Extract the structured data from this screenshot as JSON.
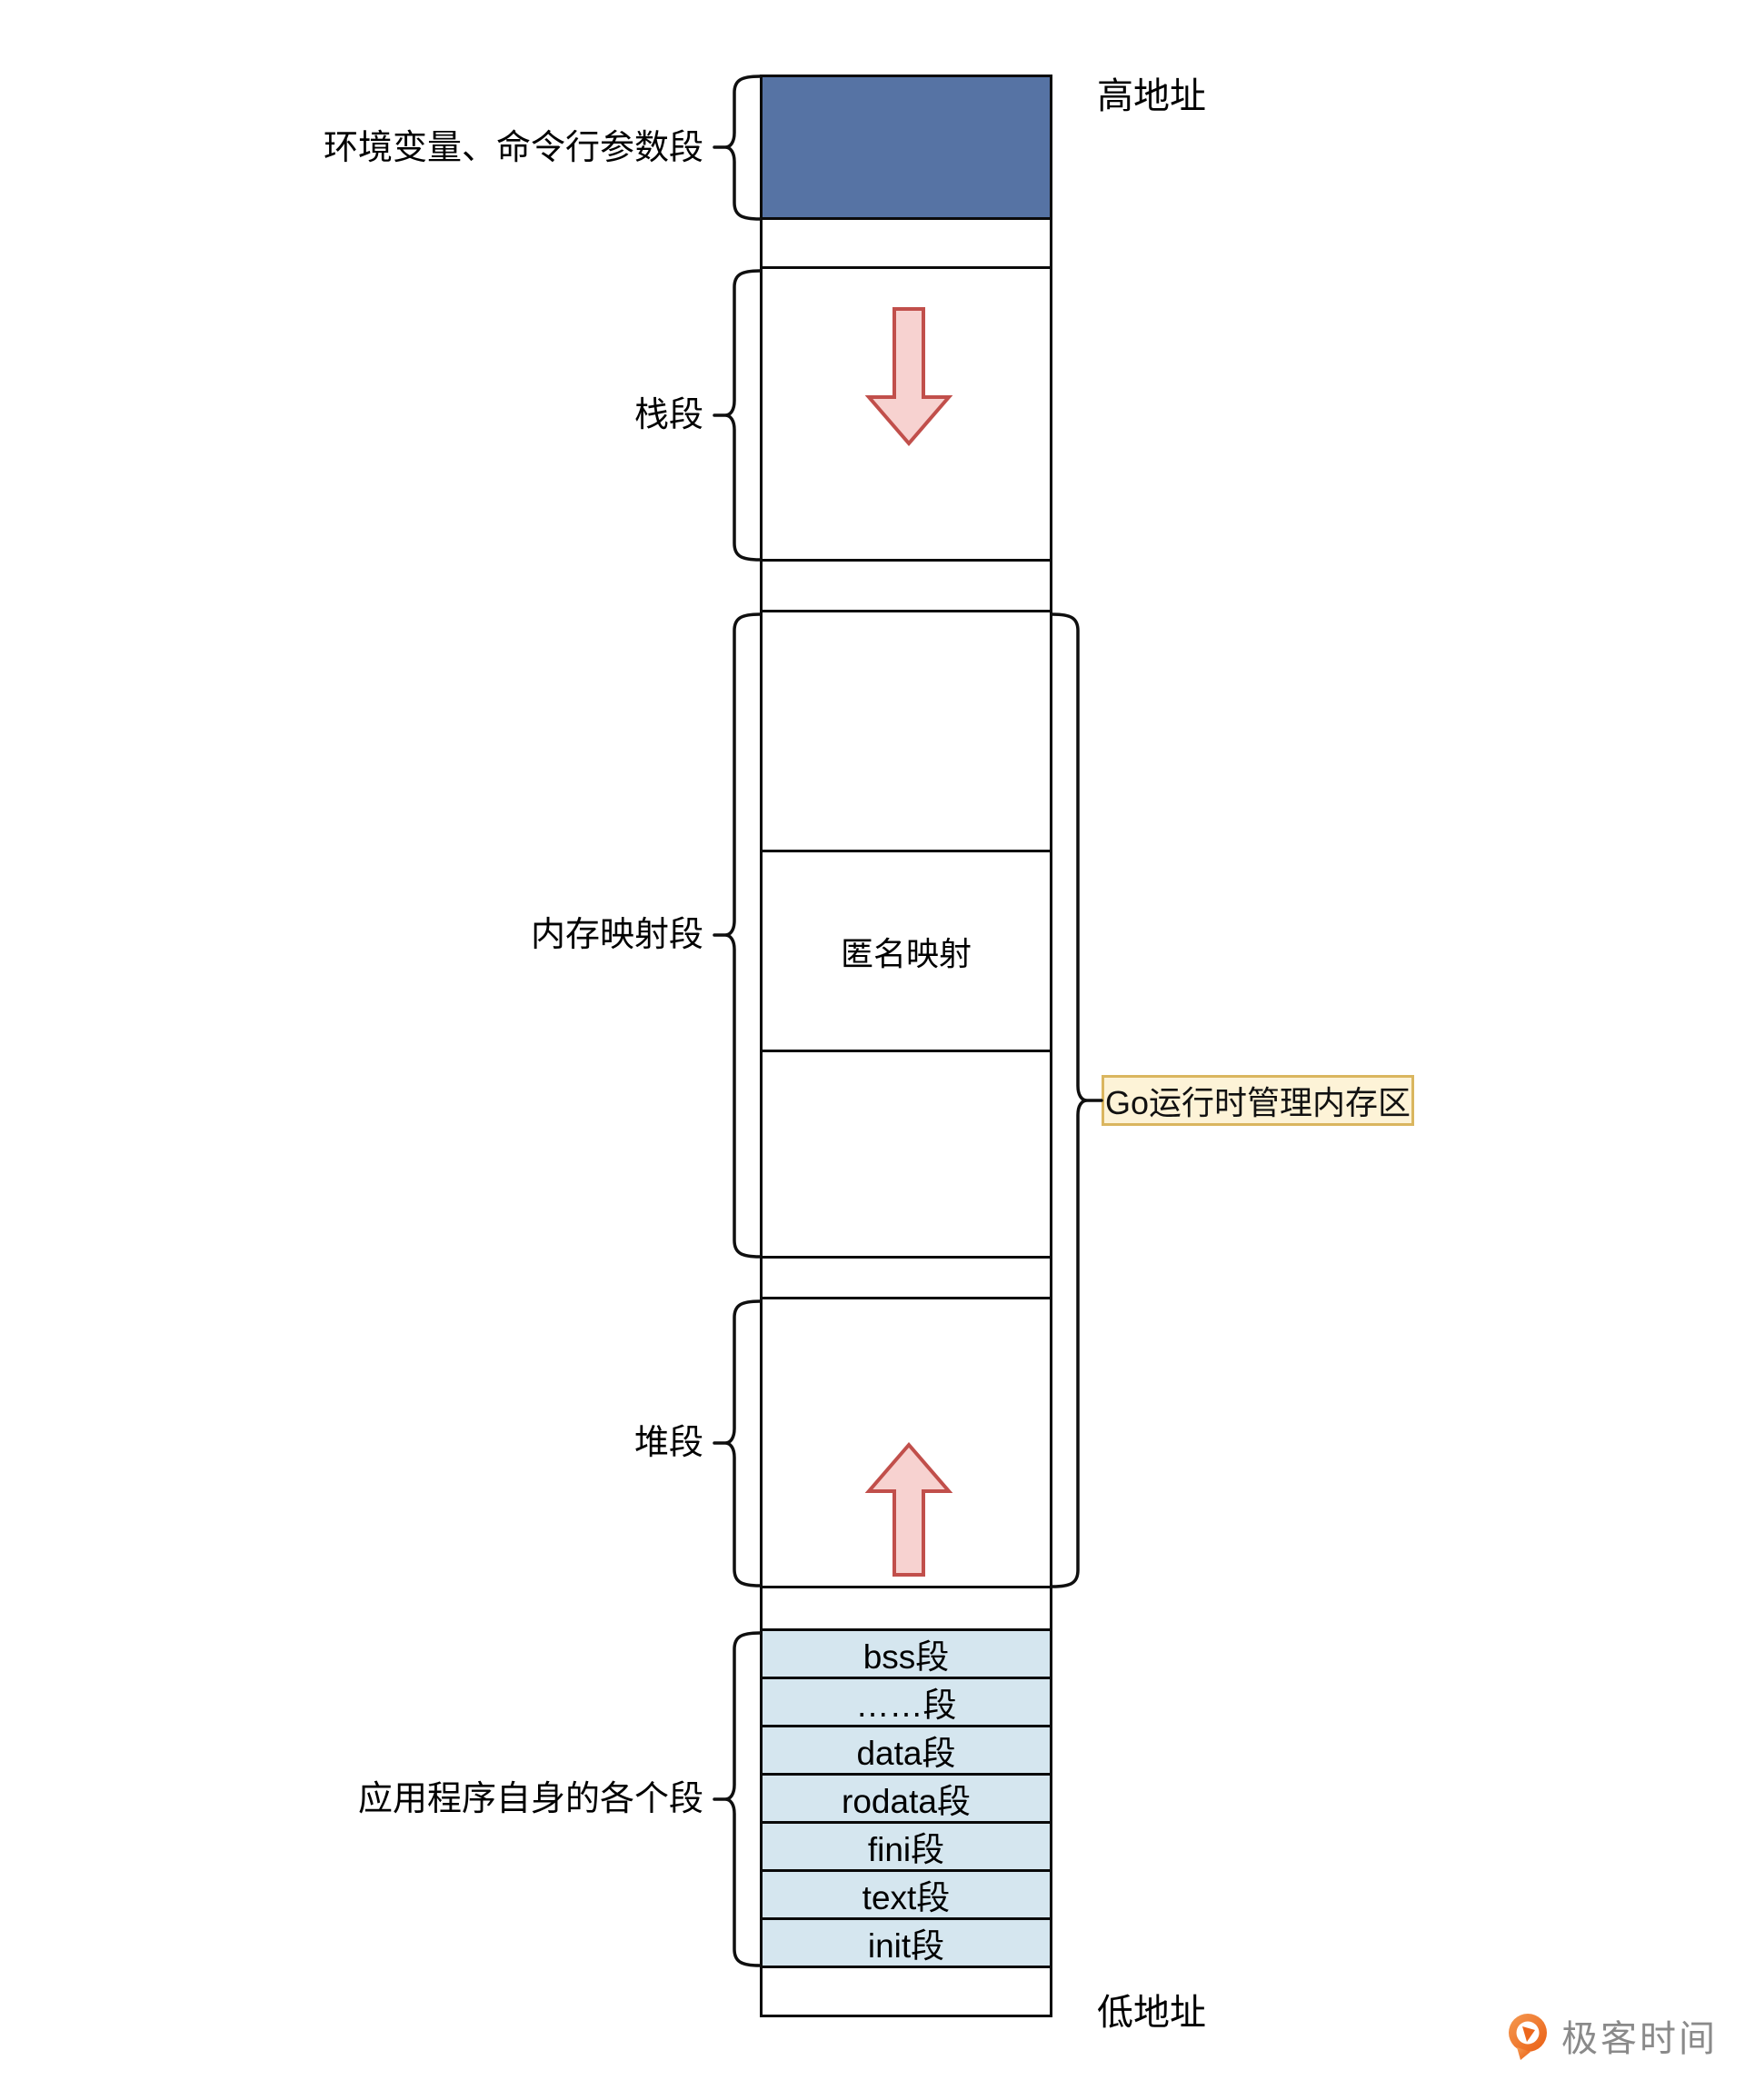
{
  "labels": {
    "high_address": "高地址",
    "low_address": "低地址",
    "env": "环境变量、命令行参数段",
    "stack": "栈段",
    "mmap": "内存映射段",
    "heap": "堆段",
    "app": "应用程序自身的各个段"
  },
  "column": {
    "anonymous_mapping": "匿名映射",
    "app_segments": [
      "bss段",
      "……段",
      "data段",
      "rodata段",
      "fini段",
      "text段",
      "init段"
    ]
  },
  "annotation": {
    "go_runtime": "Go运行时管理内存区"
  },
  "logo": {
    "text": "极客时间"
  },
  "colors": {
    "env_box_fill": "#5673a4",
    "segment_row_fill": "#d5e6ef",
    "arrow_fill": "#f7d2d0",
    "arrow_stroke": "#c14f4b",
    "annotation_bg": "#fdf3d7",
    "annotation_border": "#dab65f",
    "line": "#0a0a0a",
    "logo_orange": "#ed6a1f",
    "logo_text": "#8a8a8a"
  }
}
